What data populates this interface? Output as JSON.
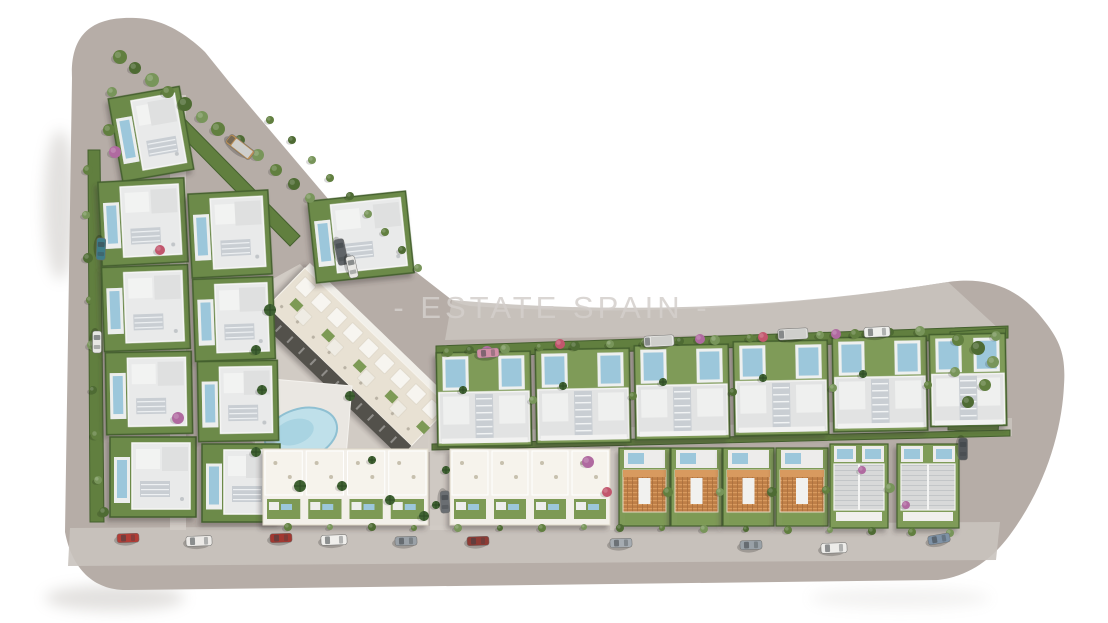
{
  "scene": {
    "watermark": {
      "text": "- ESTATE SPAIN -",
      "x": 552,
      "y": 318,
      "font_size": 31,
      "letter_spacing": 4,
      "color": "#d3cfcb",
      "opacity": 0.85
    },
    "colors": {
      "background": "#ffffff",
      "land": "#b6ada7",
      "road": "#c9c3be",
      "road_light": "#d2ccc6",
      "courtyard": "#d4cec8",
      "hedge": "#44602e",
      "green_dark": "#4e6b33",
      "green": "#617f3f",
      "green_light": "#7d9a55",
      "lawn": "#7f9b58",
      "palm": "#3f6132",
      "flower_purple": "#b06aa0",
      "flower_red": "#c2566d",
      "pool": "#9cc7db",
      "pool_light": "#bfe0ea",
      "deck": "#edeceb",
      "roof_white": "#f2f2f0",
      "roof_gray": "#e2e3e3",
      "roof_panel": "#c9ced3",
      "cream": "#e8e1d3",
      "cream_roof": "#f3f0ea",
      "dark_side": "#53514b",
      "orange_roof": "#bf7f47",
      "orange_light": "#d89a5e",
      "gable_roof": "#d8d9d9",
      "shadow": "#3a3632"
    },
    "land_outline": "M 72,78 C 70,34 92,16 136,18 C 160,19 182,30 205,52 L 230,83 L 340,213 L 452,300 Q 455,303 470,306 Q 700,322 948,282 C 990,276 1020,290 1042,318 C 1060,340 1066,355 1064,385 C 1062,430 1046,485 1012,532 C 995,556 972,576 938,580 L 128,590 C 95,591 72,570 65,532 Z",
    "roads": {
      "top_strip": "M452,300 Q700,322 948,282 L1000,330 L445,340 Z",
      "mid_road": "M428,432 L1012,418 L1012,436 L428,452 Z",
      "bottom_road": "M70,528 L1000,522 L996,560 L68,566 Z",
      "arm_lane": "M170,95 L186,95 L186,530 L170,530 Z",
      "lane1": "M430,445 L450,445 L450,530 L430,530 Z",
      "lane2": "M610,445 L624,445 L624,530 L610,530 Z",
      "courtyard": "M238,298 L300,264 L452,414 L452,452 L264,452 L238,430 Z"
    },
    "gardens": {
      "top_strip": [
        [
          436,
          346
        ],
        [
          1008,
          326
        ],
        [
          1008,
          338
        ],
        [
          436,
          358
        ]
      ],
      "right_garden": [
        [
          950,
          332
        ],
        [
          1006,
          328
        ],
        [
          998,
          432
        ],
        [
          948,
          430
        ]
      ],
      "left_strip": [
        [
          88,
          150
        ],
        [
          100,
          150
        ],
        [
          104,
          522
        ],
        [
          90,
          522
        ]
      ],
      "diag_strip": [
        [
          166,
          100
        ],
        [
          300,
          236
        ],
        [
          290,
          246
        ],
        [
          156,
          110
        ]
      ],
      "row2_strip": [
        [
          432,
          444
        ],
        [
          1010,
          430
        ],
        [
          1010,
          436
        ],
        [
          432,
          450
        ]
      ]
    }
  },
  "elements": {
    "villas": [
      [
        115,
        92,
        72,
        84,
        -10
      ],
      [
        100,
        180,
        86,
        84,
        -3
      ],
      [
        103,
        266,
        86,
        84,
        -2
      ],
      [
        106,
        352,
        86,
        82,
        -1
      ],
      [
        110,
        437,
        86,
        80,
        0
      ],
      [
        190,
        192,
        80,
        84,
        -3
      ],
      [
        194,
        278,
        80,
        82,
        -2
      ],
      [
        198,
        361,
        80,
        80,
        -1
      ],
      [
        202,
        444,
        78,
        78,
        0
      ],
      [
        312,
        196,
        98,
        82,
        -6
      ]
    ],
    "row1_villas": [
      [
        437,
        352,
        94,
        94
      ],
      [
        536,
        349,
        94,
        94
      ],
      [
        635,
        345,
        94,
        94
      ],
      [
        734,
        341,
        94,
        94
      ],
      [
        833,
        337,
        94,
        94
      ],
      [
        930,
        334,
        76,
        92
      ]
    ],
    "terraced_blocks": [
      [
        263,
        449,
        165,
        76,
        4
      ],
      [
        450,
        449,
        160,
        76,
        4
      ]
    ],
    "orange_houses": [
      [
        619,
        448,
        51,
        78
      ],
      [
        671,
        448,
        51,
        78
      ],
      [
        723,
        448,
        51,
        78
      ],
      [
        776,
        448,
        52,
        78
      ]
    ],
    "gable_houses": [
      [
        830,
        444,
        58,
        84
      ],
      [
        897,
        444,
        62,
        84
      ]
    ],
    "apartment": {
      "x": 305,
      "y": 268,
      "rot": 44,
      "len": 200,
      "depth": 54,
      "dark": 16
    },
    "pool_area": {
      "deck": [
        [
          260,
          378
        ],
        [
          352,
          386
        ],
        [
          344,
          480
        ],
        [
          254,
          468
        ]
      ],
      "pool": {
        "cx": 301,
        "cy": 434,
        "rx": 37,
        "ry": 25,
        "rot": -18
      }
    },
    "cars": [
      [
        128,
        538,
        -2,
        0,
        "#b23d36"
      ],
      [
        199,
        541,
        -2,
        1,
        "#eceae7"
      ],
      [
        281,
        538,
        -2,
        0,
        "#a23831"
      ],
      [
        334,
        540,
        -2,
        1,
        "#f0efec"
      ],
      [
        406,
        541,
        -2,
        0,
        "#9aa1a7"
      ],
      [
        478,
        541,
        -2,
        0,
        "#8e3b34"
      ],
      [
        621,
        543,
        -2,
        0,
        "#a6acb2"
      ],
      [
        751,
        545,
        -2,
        0,
        "#99a1a7"
      ],
      [
        834,
        548,
        -2,
        1,
        "#edece9"
      ],
      [
        939,
        539,
        -10,
        0,
        "#7e92a6"
      ],
      [
        240,
        147,
        38,
        2,
        "#b98e55"
      ],
      [
        341,
        252,
        78,
        1,
        "#606468"
      ],
      [
        352,
        267,
        78,
        0,
        "#e9e8e5"
      ],
      [
        488,
        353,
        -4,
        0,
        "#d28fa6"
      ],
      [
        659,
        341,
        -3,
        2,
        "#e7e7e4"
      ],
      [
        793,
        334,
        -3,
        2,
        "#dededb"
      ],
      [
        877,
        332,
        -3,
        1,
        "#efefec"
      ],
      [
        101,
        249,
        92,
        0,
        "#3f7c87"
      ],
      [
        97,
        342,
        90,
        0,
        "#e7e7e4"
      ],
      [
        445,
        502,
        88,
        0,
        "#6a6e72"
      ],
      [
        963,
        449,
        90,
        0,
        "#53575b"
      ]
    ],
    "trees": [
      [
        120,
        57,
        7,
        1
      ],
      [
        135,
        68,
        6,
        0
      ],
      [
        152,
        80,
        7,
        2
      ],
      [
        168,
        92,
        6,
        1
      ],
      [
        185,
        104,
        7,
        0
      ],
      [
        202,
        117,
        6,
        2
      ],
      [
        218,
        129,
        7,
        1
      ],
      [
        112,
        92,
        5,
        2
      ],
      [
        109,
        130,
        6,
        1
      ],
      [
        240,
        140,
        5,
        0
      ],
      [
        258,
        155,
        6,
        2
      ],
      [
        276,
        170,
        6,
        1
      ],
      [
        294,
        184,
        6,
        0
      ],
      [
        310,
        198,
        5,
        2
      ],
      [
        88,
        170,
        5,
        1
      ],
      [
        86,
        215,
        4,
        2
      ],
      [
        88,
        258,
        5,
        0
      ],
      [
        90,
        300,
        4,
        1
      ],
      [
        92,
        345,
        5,
        2
      ],
      [
        93,
        390,
        4,
        0
      ],
      [
        96,
        435,
        5,
        1
      ],
      [
        98,
        480,
        4,
        2
      ],
      [
        104,
        512,
        5,
        0
      ],
      [
        270,
        120,
        4,
        1
      ],
      [
        292,
        140,
        4,
        0
      ],
      [
        312,
        160,
        4,
        2
      ],
      [
        330,
        178,
        4,
        1
      ],
      [
        350,
        196,
        4,
        0
      ],
      [
        368,
        214,
        4,
        2
      ],
      [
        385,
        232,
        4,
        1
      ],
      [
        402,
        250,
        4,
        0
      ],
      [
        418,
        268,
        4,
        2
      ],
      [
        270,
        310,
        6,
        3
      ],
      [
        256,
        350,
        5,
        3
      ],
      [
        262,
        390,
        5,
        3
      ],
      [
        350,
        396,
        5,
        3
      ],
      [
        256,
        452,
        5,
        3
      ],
      [
        300,
        486,
        6,
        3
      ],
      [
        342,
        486,
        5,
        3
      ],
      [
        390,
        500,
        5,
        3
      ],
      [
        424,
        516,
        5,
        3
      ],
      [
        372,
        460,
        4,
        3
      ],
      [
        448,
        352,
        5,
        1
      ],
      [
        470,
        350,
        4,
        0
      ],
      [
        505,
        349,
        5,
        2
      ],
      [
        540,
        347,
        4,
        1
      ],
      [
        575,
        346,
        5,
        0
      ],
      [
        610,
        344,
        4,
        2
      ],
      [
        645,
        343,
        5,
        1
      ],
      [
        680,
        341,
        4,
        0
      ],
      [
        715,
        340,
        5,
        2
      ],
      [
        750,
        338,
        4,
        1
      ],
      [
        785,
        337,
        5,
        0
      ],
      [
        820,
        335,
        4,
        2
      ],
      [
        855,
        334,
        5,
        1
      ],
      [
        890,
        332,
        4,
        0
      ],
      [
        920,
        331,
        5,
        2
      ],
      [
        487,
        352,
        6,
        4
      ],
      [
        560,
        344,
        5,
        5
      ],
      [
        700,
        339,
        5,
        4
      ],
      [
        763,
        337,
        5,
        5
      ],
      [
        836,
        334,
        5,
        4
      ],
      [
        958,
        340,
        6,
        1
      ],
      [
        978,
        348,
        7,
        0
      ],
      [
        993,
        362,
        6,
        2
      ],
      [
        985,
        385,
        6,
        1
      ],
      [
        968,
        402,
        6,
        0
      ],
      [
        996,
        336,
        5,
        2
      ],
      [
        955,
        372,
        5,
        2
      ],
      [
        533,
        400,
        4,
        2
      ],
      [
        633,
        396,
        4,
        1
      ],
      [
        733,
        392,
        4,
        0
      ],
      [
        833,
        388,
        4,
        2
      ],
      [
        928,
        385,
        4,
        1
      ],
      [
        668,
        492,
        5,
        1
      ],
      [
        720,
        492,
        4,
        2
      ],
      [
        772,
        492,
        5,
        0
      ],
      [
        826,
        490,
        4,
        1
      ],
      [
        890,
        488,
        5,
        2
      ],
      [
        862,
        470,
        4,
        4
      ],
      [
        906,
        505,
        4,
        4
      ],
      [
        588,
        462,
        6,
        4
      ],
      [
        607,
        492,
        5,
        5
      ],
      [
        436,
        505,
        4,
        3
      ],
      [
        446,
        470,
        4,
        3
      ],
      [
        288,
        527,
        4,
        1
      ],
      [
        330,
        527,
        3,
        2
      ],
      [
        372,
        527,
        4,
        0
      ],
      [
        414,
        528,
        3,
        1
      ],
      [
        458,
        528,
        4,
        2
      ],
      [
        500,
        528,
        3,
        0
      ],
      [
        542,
        528,
        4,
        1
      ],
      [
        584,
        527,
        3,
        2
      ],
      [
        620,
        528,
        4,
        0
      ],
      [
        662,
        528,
        3,
        1
      ],
      [
        704,
        529,
        4,
        2
      ],
      [
        746,
        529,
        3,
        0
      ],
      [
        788,
        530,
        4,
        1
      ],
      [
        830,
        530,
        3,
        2
      ],
      [
        872,
        531,
        4,
        0
      ],
      [
        912,
        532,
        4,
        1
      ],
      [
        950,
        533,
        4,
        2
      ],
      [
        178,
        418,
        6,
        4
      ],
      [
        160,
        250,
        5,
        5
      ],
      [
        115,
        152,
        6,
        4
      ],
      [
        463,
        390,
        4,
        3
      ],
      [
        563,
        386,
        4,
        3
      ],
      [
        663,
        382,
        4,
        3
      ],
      [
        763,
        378,
        4,
        3
      ],
      [
        863,
        374,
        4,
        3
      ]
    ],
    "tree_shades": [
      "#4e6b33",
      "#617f3f",
      "#78955a",
      "#3f6132",
      "#b06aa0",
      "#c2566d"
    ]
  }
}
